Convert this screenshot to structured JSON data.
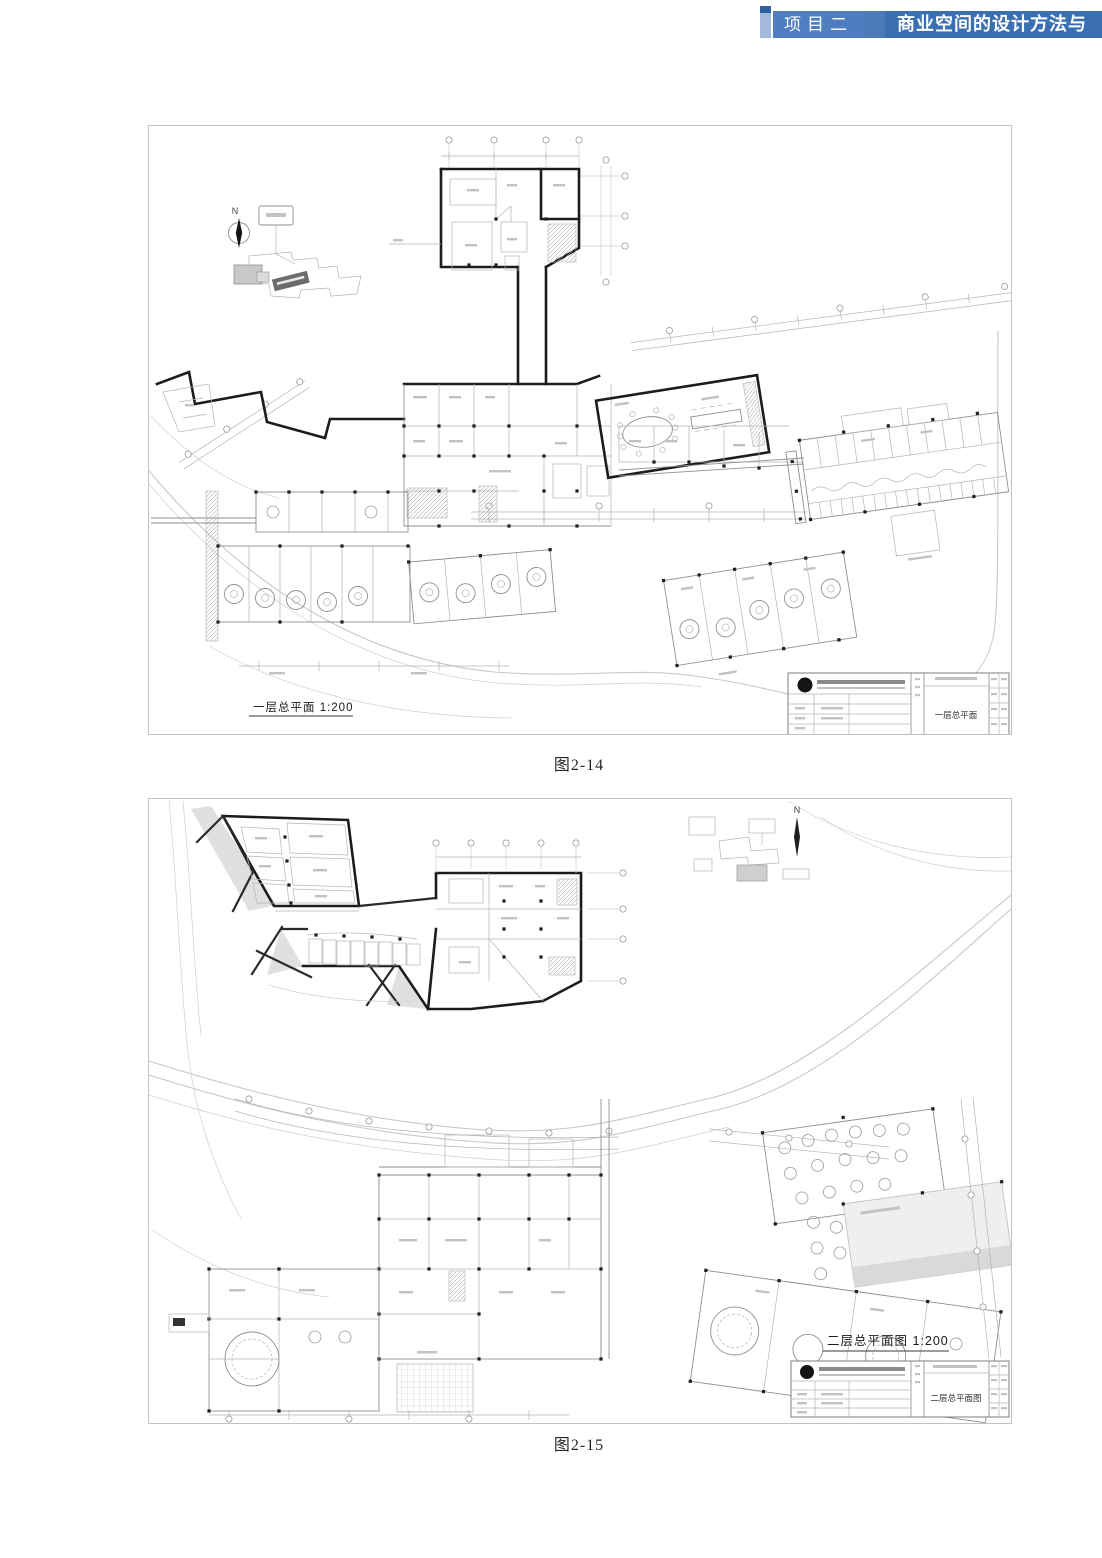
{
  "header": {
    "tab_label": "项目二",
    "title": "商业空间的设计方法与"
  },
  "figure1": {
    "caption": "图2-14",
    "plan_label": "一层总平面 1:200",
    "north_label": "N",
    "titleblock_title": "一层总平面"
  },
  "figure2": {
    "caption": "图2-15",
    "plan_label": "二层总平面图 1:200",
    "north_label": "N",
    "titleblock_title": "二层总平面图"
  },
  "colors": {
    "header_strip": "#a4bada",
    "header_tab": "#4e7ebf",
    "header_main": "#3a70b2",
    "plan_line_dark": "#1c1c1c",
    "plan_line_light": "#b5b5b5"
  }
}
